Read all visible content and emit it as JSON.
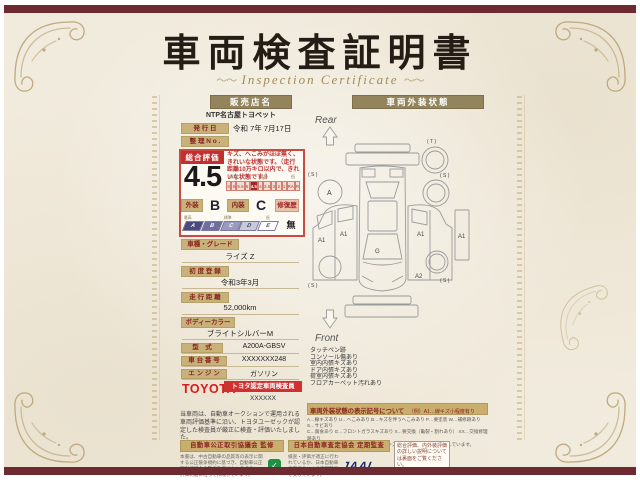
{
  "title": "車両検査証明書",
  "subtitle": "Inspection Certificate",
  "left": {
    "dealer_header": "販売店名",
    "dealer_name": "NTP名古屋トヨペット",
    "issue_date_label": "発 行 日",
    "issue_date": "令和 7年 7月17日",
    "ref_no_label": "整 理 N o .",
    "ref_no": "",
    "rating": {
      "label": "総合評価",
      "score": "4.5",
      "description": "キズ、へこみがほぼ無く、きれいな状態です。（走行距離10万キロ以内で、きれいな状態です。）",
      "scale_high": "最高",
      "scale_mid": "標準",
      "scale_low": "低",
      "scale": [
        "S",
        "6",
        "5.5",
        "5",
        "4.5",
        "4",
        "3.5",
        "3",
        "2",
        "1",
        "RA",
        "R"
      ],
      "exterior_label": "外装",
      "exterior_grade": "B",
      "interior_label": "内装",
      "interior_grade": "C",
      "repair_label": "修復歴",
      "repair_value": "無",
      "grade_scale": [
        "A",
        "B",
        "C",
        "D",
        "E"
      ]
    },
    "fields": [
      {
        "label": "車種・グレード",
        "value": "ライズ Z"
      },
      {
        "label": "初 度 登 録",
        "value": "令和3年3月"
      },
      {
        "label": "走 行 距 離",
        "value": "52,000km"
      },
      {
        "label": "ボディーカラー",
        "value": "ブライトシルバーM"
      }
    ],
    "spec_rows": [
      {
        "label": "型　式",
        "value": "A200A-GBSV"
      },
      {
        "label": "車 台 番 号",
        "value": "XXXXXXX248"
      },
      {
        "label": "エ ン ジ ン",
        "value": "ガソリン"
      }
    ],
    "toyota_logo": "TOYOTA",
    "inspector_badge": "トヨタ認定車両検査員",
    "inspector_id": "XXXXXX",
    "disclaimer": "当車両は、自動車オークションで運用される車両評価基準に沿い、トヨタユーゼックが認定した検査員が厳正に検査・評価いたしました。"
  },
  "right": {
    "header": "車両外装状態",
    "rear_label": "Rear",
    "front_label": "Front",
    "diagram": {
      "spare_label": "( T )",
      "tire_label": "( S )",
      "tire_mark": "A",
      "mark_left_outer": "A1",
      "mark_left_inner": "A1",
      "mark_right_inner": "A1",
      "mark_right_sill": "A1",
      "mark_front_right": "A2",
      "mark_glass": "G"
    },
    "notes": [
      "タッチペン跡",
      "コンソール傷あり",
      "室内内張キズあり",
      "ドア内張キズあり",
      "荷室内張キズあり",
      "フロアカーペット汚れあり"
    ],
    "legend": {
      "header": "車両外装状態の表示記号について",
      "header_example": "（例）A1…線キズ小程度有り",
      "lines": [
        "A…線キズあり U…へこみあり B…キズを伴うへこみあり P…要塗装 W…補修跡あり S…サビあり",
        "C…腐食あり G…フロントガラスキズあり X…要交換（亀裂・割れあり） XX…交換修理跡あり",
        "1…小程度 2…中程度 3…中程度以上 ・キズ等の数字は、程度差を表しています。"
      ]
    }
  },
  "footer": {
    "fair_trade": {
      "header": "自動車公正取引協議会 監修",
      "body": "本書は、中古自動車の品質等の表示に関する公正競争規約に基づき、自動車公正取引協議会の監修を受けたトヨタのU-Car評価制度に沿って作成しています。"
    },
    "jaai": {
      "header": "日本自動車査定協会 定期監査",
      "body": "検査・評価が適正に行われているか、日本自動車査定協会による定期監査を受けています。",
      "logo": "JAAI"
    },
    "note_box": "総合評価、内外装評価の詳しい説明については裏面をご覧ください。"
  }
}
